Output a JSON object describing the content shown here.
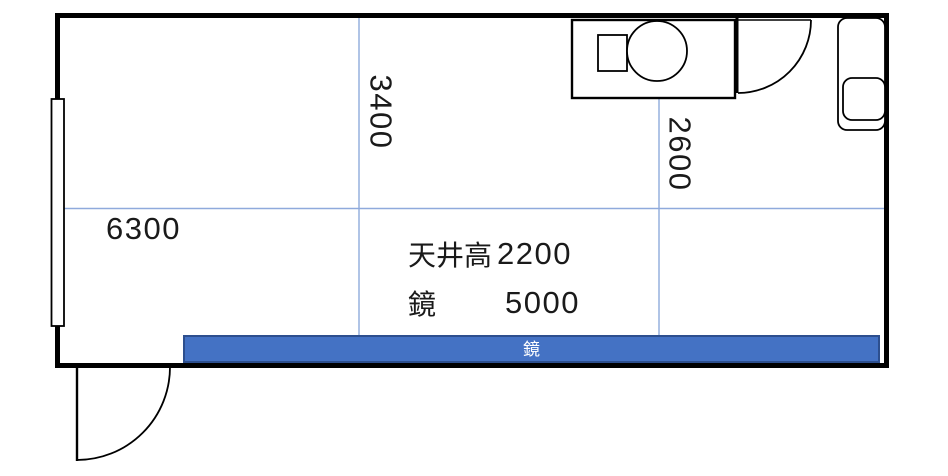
{
  "plan": {
    "title": "room-floor-plan",
    "labels": {
      "room_width": "6300",
      "room_depth_center": "3400",
      "room_depth_right": "2600",
      "ceiling_label": "天井高",
      "ceiling_value": "2200",
      "mirror_label": "鏡",
      "mirror_value": "5000",
      "mirror_bar": "鏡"
    },
    "colors": {
      "wall": "#000000",
      "grid_line": "#8faadc",
      "mirror_fill": "#4472c4",
      "mirror_border": "#2d4f8e",
      "mirror_text": "#ffffff",
      "dimension_text": "#1a1a1a"
    },
    "fixtures": [
      {
        "name": "window",
        "location": "left-wall"
      },
      {
        "name": "toilet",
        "location": "top-right"
      },
      {
        "name": "door-swing",
        "location": "top-right-interior"
      },
      {
        "name": "sink-cabinet",
        "location": "right-wall"
      },
      {
        "name": "door-swing",
        "location": "bottom-left-exterior"
      },
      {
        "name": "mirror",
        "location": "bottom-wall"
      }
    ]
  }
}
